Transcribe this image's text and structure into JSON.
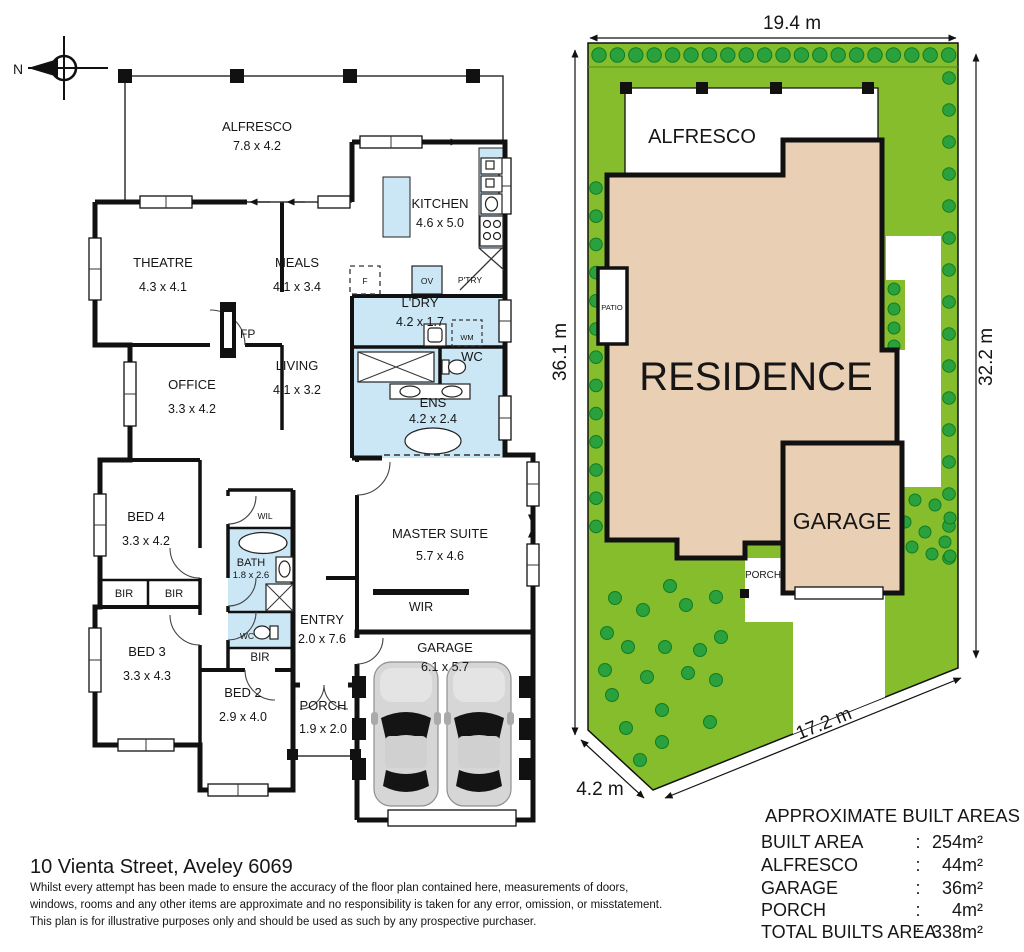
{
  "floorplan": {
    "compass_label": "N",
    "rooms": [
      {
        "name": "ALFRESCO",
        "dims": "7.8 x 4.2"
      },
      {
        "name": "KITCHEN",
        "dims": "4.6 x 5.0"
      },
      {
        "name": "THEATRE",
        "dims": "4.3 x 4.1"
      },
      {
        "name": "MEALS",
        "dims": "4.1 x 3.4"
      },
      {
        "name": "L'DRY",
        "dims": "4.2 x 1.7"
      },
      {
        "name": "OFFICE",
        "dims": "3.3 x 4.2"
      },
      {
        "name": "LIVING",
        "dims": "4.1 x 3.2"
      },
      {
        "name": "ENS",
        "dims": "4.2 x 2.4"
      },
      {
        "name": "BED 4",
        "dims": "3.3 x 4.2"
      },
      {
        "name": "MASTER SUITE",
        "dims": "5.7 x 4.6"
      },
      {
        "name": "BATH",
        "dims": "1.8 x 2.6"
      },
      {
        "name": "ENTRY",
        "dims": "2.0 x 7.6"
      },
      {
        "name": "BED 3",
        "dims": "3.3 x 4.3"
      },
      {
        "name": "BED 2",
        "dims": "2.9 x 4.0"
      },
      {
        "name": "PORCH",
        "dims": "1.9 x 2.0"
      },
      {
        "name": "GARAGE",
        "dims": "6.1 x 5.7"
      }
    ],
    "fixtures": {
      "fireplace": "FP",
      "fridge": "F",
      "oven": "OV",
      "pantry": "P'TRY",
      "washing_machine": "WM",
      "wc": "WC",
      "walk_in_linen": "WIL",
      "built_in_robe": "BIR",
      "walk_in_robe": "WIR"
    }
  },
  "siteplan": {
    "residence_label": "RESIDENCE",
    "alfresco_label": "ALFRESCO",
    "garage_label": "GARAGE",
    "porch_label": "PORCH",
    "patio_label": "PATIO",
    "dim_top": "19.4 m",
    "dim_left": "36.1 m",
    "dim_right": "32.2 m",
    "dim_bottom_diagonal": "17.2 m",
    "dim_bottom_left": "4.2 m"
  },
  "built_areas": {
    "title": "APPROXIMATE BUILT AREAS",
    "colon": ":",
    "rows": [
      {
        "label": "BUILT AREA",
        "value": "254m²"
      },
      {
        "label": "ALFRESCO",
        "value": "44m²"
      },
      {
        "label": "GARAGE",
        "value": "36m²"
      },
      {
        "label": "PORCH",
        "value": "4m²"
      },
      {
        "label": "TOTAL BUILTS AREA",
        "value": "338m²"
      }
    ]
  },
  "footer": {
    "address": "10 Vienta Street, Aveley 6069",
    "disclaimer_lines": [
      "Whilst every attempt has been made to ensure the accuracy of the floor plan contained here, measurements of doors,",
      "windows, rooms and any other items are approximate and no responsibility is taken for any error, omission, or misstatement.",
      "This plan is for illustrative purposes only and should be used as such by any prospective purchaser."
    ]
  },
  "colors": {
    "wet_area": "#cbe7f5",
    "lawn": "#86bd2d",
    "tree": "#2aa13c",
    "tree_stroke": "#0f7d24",
    "residence": "#e9cfb4",
    "wall": "#111111"
  }
}
